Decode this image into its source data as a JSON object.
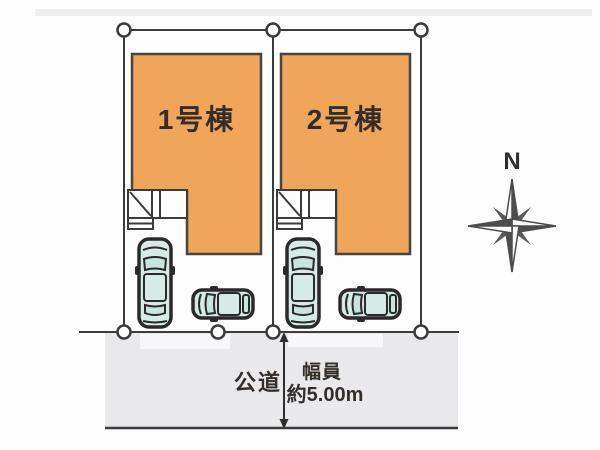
{
  "title": "分譲地区画図 (site plan)",
  "colors": {
    "building_fill": "#efa55a",
    "building_border": "#47453f",
    "line": "#3b3b3b",
    "road_fill": "#e9e9ec",
    "car_body": "#d7ebe6",
    "car_window": "#c9e4de",
    "car_outline": "#2a2a2a",
    "text": "#332e29",
    "compass": "#4d4d4d",
    "paper": "#fdfdfd"
  },
  "lots": [
    {
      "label": "1号棟"
    },
    {
      "label": "2号棟"
    }
  ],
  "road": {
    "name": "公道",
    "width_caption": "幅員",
    "width_value": "約5.00m"
  },
  "compass": {
    "north_label": "N"
  },
  "icons": [
    "car-top-view-icon",
    "compass-rose-icon",
    "survey-marker-icon",
    "width-arrow-icon"
  ]
}
